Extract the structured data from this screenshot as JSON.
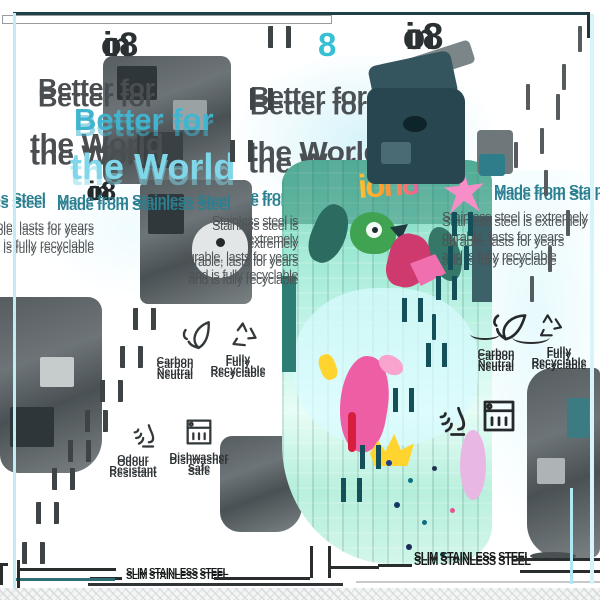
{
  "brand": {
    "full": "ion8",
    "ion": "ion",
    "eight": "8"
  },
  "title": {
    "line1": "Better for",
    "line2": "the World"
  },
  "subtitle": "Made from Stainless Steel",
  "description": {
    "line1": "Stainless steel is extremely",
    "line2": "durable, lasts for years",
    "line3": "and is fully recyclable"
  },
  "features": [
    {
      "label": "Carbon Neutral",
      "icon": "leaf-icon"
    },
    {
      "label": "Fully Recyclable",
      "icon": "recycle-icon"
    },
    {
      "label": "Odour Resistant",
      "icon": "nose-icon"
    },
    {
      "label": "Dishwasher Safe",
      "icon": "dishwasher-icon"
    }
  ],
  "banner": "SLIM STAINLESS STEEL",
  "bottle_print": "ion8",
  "colors": {
    "accent_cyan": "#41b5cf",
    "light_cyan": "#7fd7e9",
    "teal": "#2b7f90",
    "dark_text": "#45494c",
    "bottle_teal": "#8adfce",
    "bottle_pink": "#ee5ea5",
    "bottle_yellow": "#ffd42e",
    "cap_petrol": "#28464f"
  }
}
